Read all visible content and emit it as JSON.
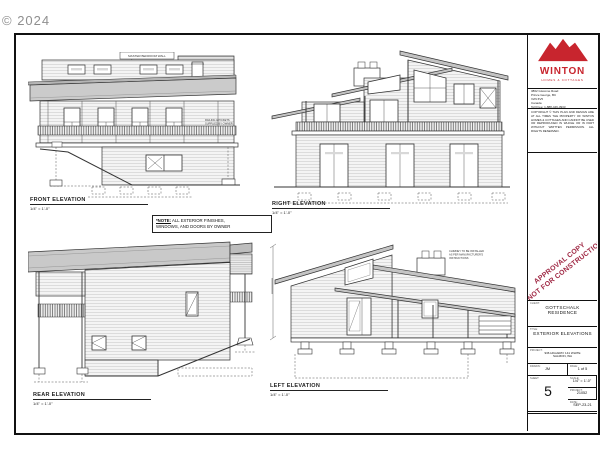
{
  "watermark": "© 2024",
  "note": {
    "prefix": "*NOTE:",
    "line1": "ALL EXTERIOR FINISHES,",
    "line2": "WINDOWS, AND DOORS BY OWNER"
  },
  "drawings": {
    "front": {
      "title": "FRONT ELEVATION",
      "scale": "1/4\" = 1'-0\"",
      "callout": "MASTER BEDROOM WALL",
      "railing_note_1": "RAILING & PICKETS",
      "railing_note_2": "SUPPLIED BY OWNER"
    },
    "right": {
      "title": "RIGHT ELEVATION",
      "scale": "1/4\" = 1'-0\""
    },
    "rear": {
      "title": "REAR ELEVATION",
      "scale": "1/4\" = 1'-0\""
    },
    "left": {
      "title": "LEFT ELEVATION",
      "scale": "1/4\" = 1'-0\"",
      "chimney_note_1": "CHIMNEY TO BE INSTALLED",
      "chimney_note_2": "AS PER MANUFACTURER'S",
      "chimney_note_3": "INSTRUCTIONS"
    }
  },
  "title_block": {
    "company": "WINTON",
    "tagline": "HOMES & COTTAGES",
    "brand_color": "#c8252e",
    "address_lines": [
      "3862 Giscome Road",
      "Prince George, BC",
      "V2N 6V5",
      "Canada"
    ],
    "phone": "Toll Free: 1-888-449-3933",
    "website": "wintonhomes.ca",
    "disclaimer": "COPYRIGHT © THIS PLAN AND DESIGN ARE AT ALL TIMES THE PROPERTY OF WINTON HOMES & COTTAGES AND CANNOT BE USED OR REPRODUCED IN WHOLE OR IN PART WITHOUT WRITTEN PERMISSION. ALL RIGHTS RESERVED.",
    "stamp_line1": "APPROVAL COPY",
    "stamp_line2": "NOT FOR CONSTRUCTION",
    "stamp_color": "#a02945",
    "client_label": "CLIENT:",
    "client": "GOTTSCHALK RESIDENCE",
    "sheet_title_label": "TITLE:",
    "sheet_title": "EXTERIOR ELEVATIONS",
    "project_address_label": "PROJECT:",
    "project_address_1": "936 HIGHWAY 141 WHITE",
    "project_address_2": "SALMON, WA",
    "fields": {
      "drawn_label": "DRAWN:",
      "drawn": "JM",
      "page_label": "PAGE:",
      "page": "1 of 5",
      "scale_label": "SCALE:",
      "scale": "1/4\" = 1'-0\"",
      "project_label": "PROJECT:",
      "project": "21052",
      "date_label": "DATE:",
      "date": "SEP-23-21",
      "sheet_label": "SHEET:",
      "sheet_number": "5"
    }
  }
}
